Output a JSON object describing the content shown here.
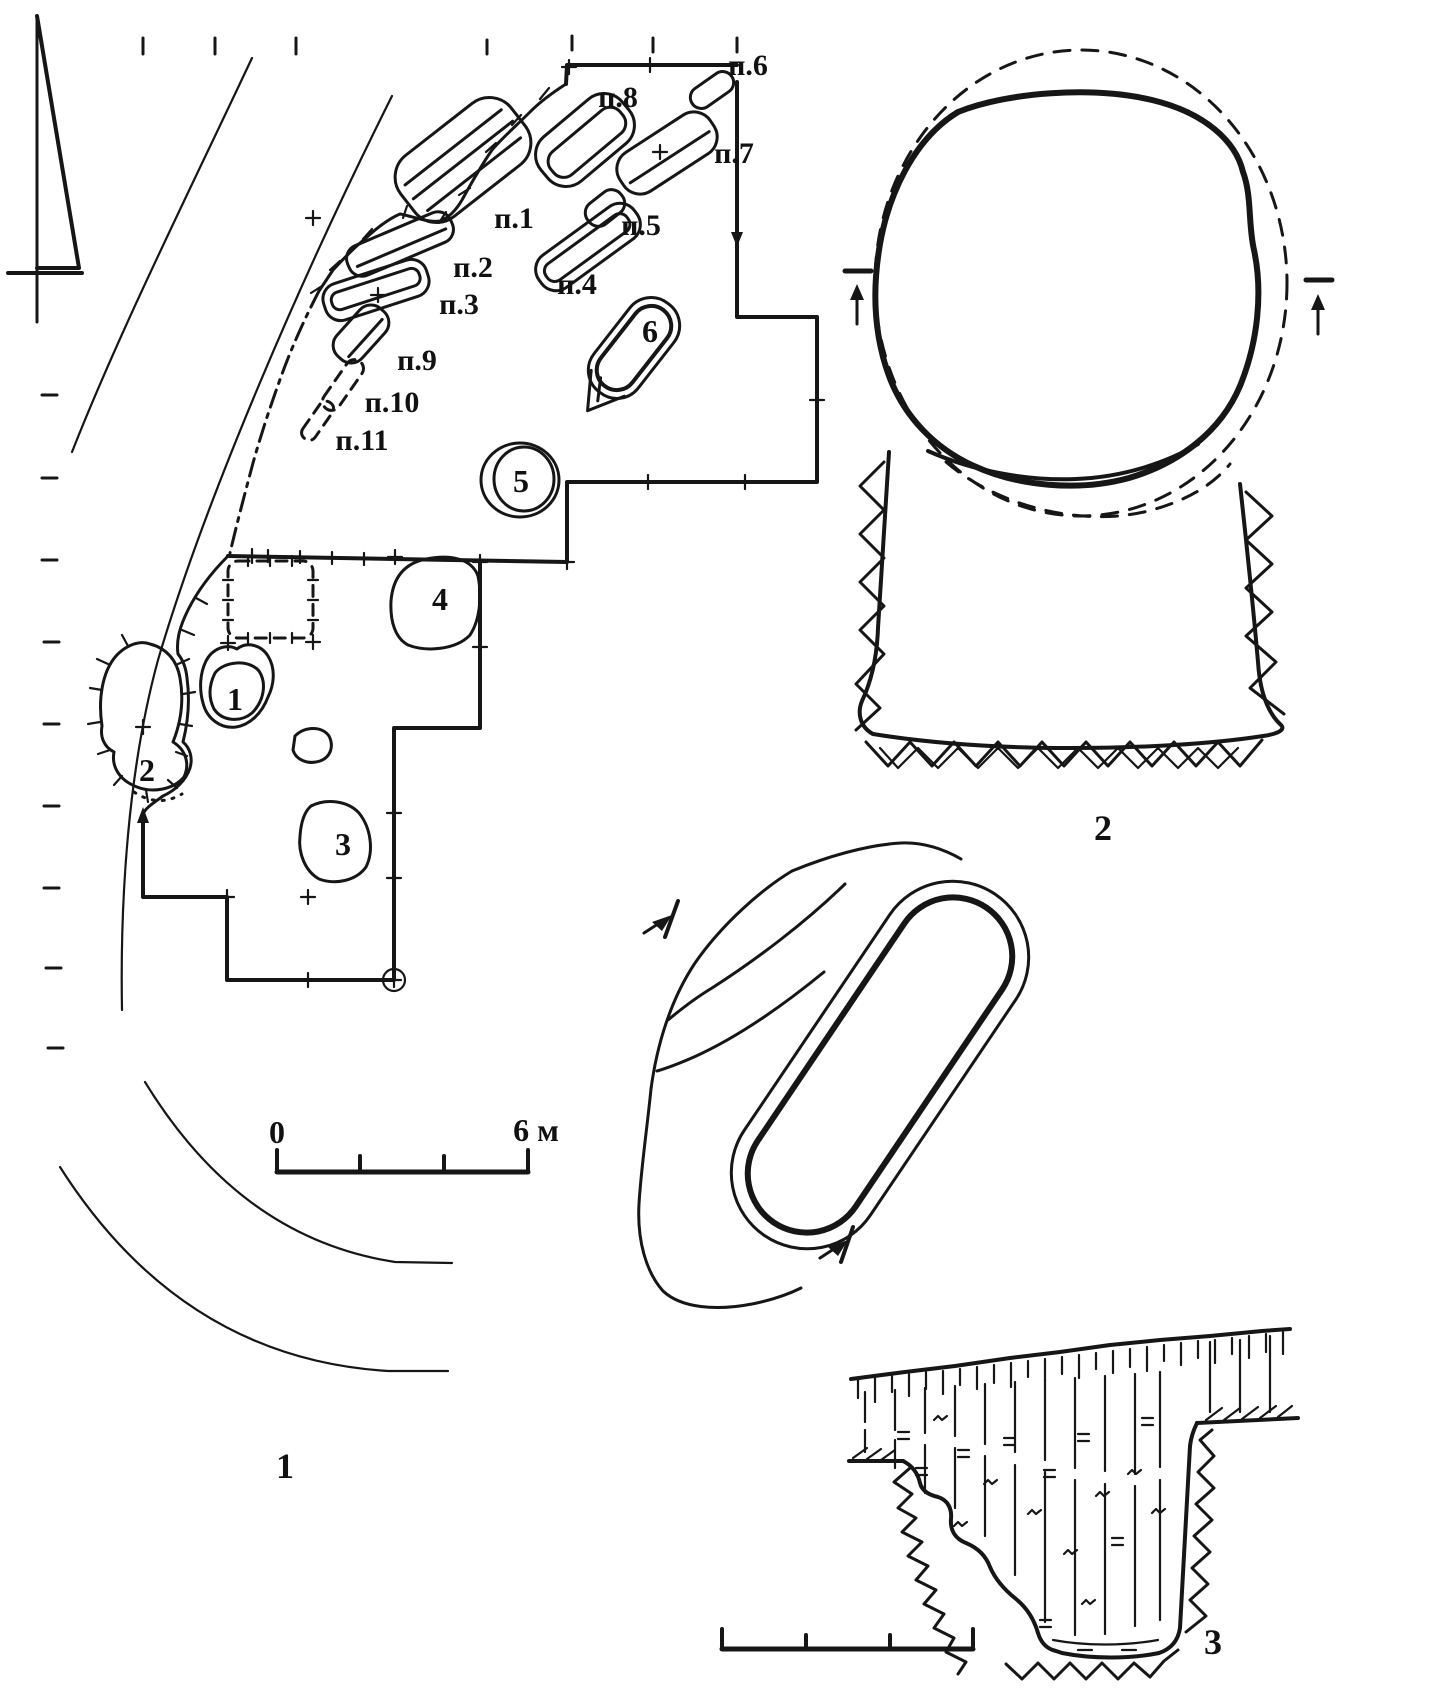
{
  "meta": {
    "description": "Archaeological excavation plan with burial spots and pit sections",
    "ink_color": "#161616",
    "paper_color": "#ffffff"
  },
  "plan": {
    "figure_label": "1",
    "graves": {
      "p1": "п.1",
      "p2": "п.2",
      "p3": "п.3",
      "p4": "п.4",
      "p5": "п.5",
      "p6": "п.6",
      "p7": "п.7",
      "p8": "п.8",
      "p9": "п.9",
      "p10": "п.10",
      "p11": "п.11"
    },
    "pits": {
      "n1": "1",
      "n2": "2",
      "n3": "3",
      "n4": "4",
      "n5": "5",
      "n6": "6"
    },
    "scale": {
      "zero": "0",
      "six": "6 м"
    }
  },
  "pit_plan_section": {
    "figure_label": "2"
  },
  "pit_profile": {
    "figure_label": "3"
  }
}
